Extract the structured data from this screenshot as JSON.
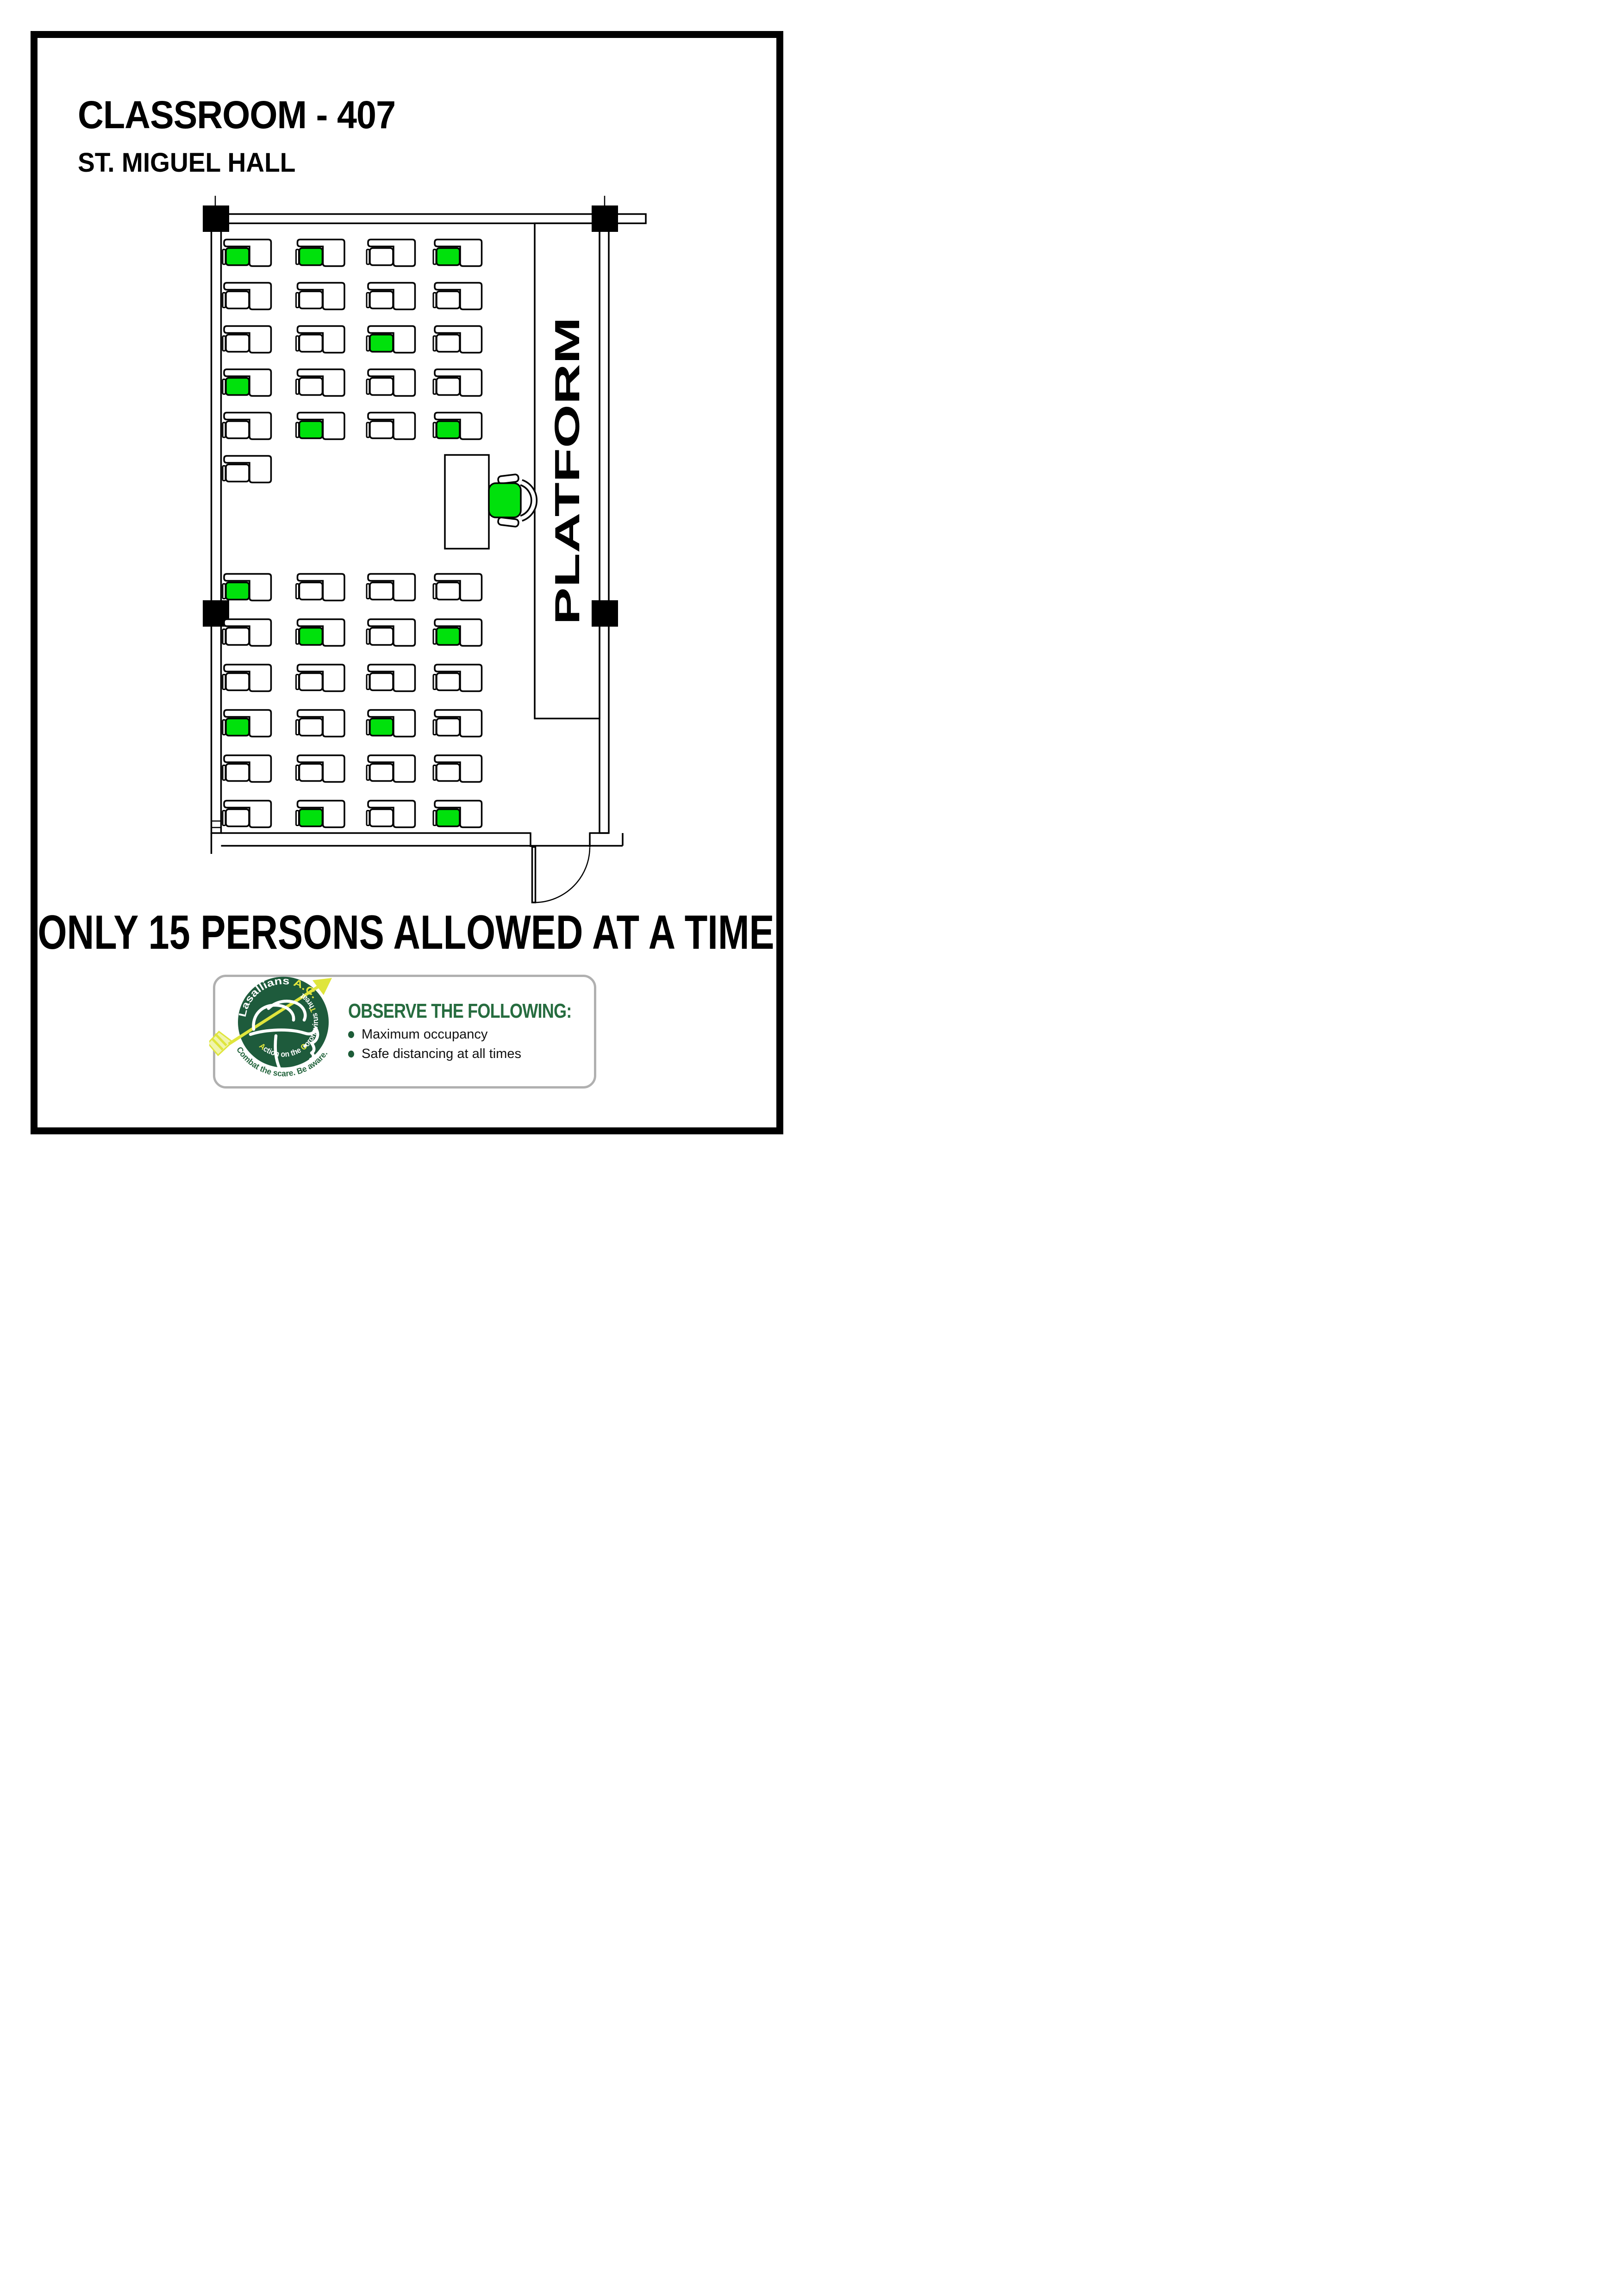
{
  "header": {
    "room_title": "CLASSROOM - 407",
    "building": "ST. MIGUEL HALL"
  },
  "capacity_notice": "ONLY 15 PERSONS ALLOWED AT A TIME",
  "floor_plan": {
    "platform_label": "PLATFORM",
    "persons_allowed": 15,
    "colors": {
      "seat_available": "#00E10C",
      "line": "#000000"
    },
    "seat_legend": {
      "G": "allowed seat (green)",
      "W": "blocked seat (white)",
      "-": "no desk"
    },
    "sections": [
      {
        "name": "platform-side block (top)",
        "rows": [
          "GGWG",
          "WWWW",
          "WWGW",
          "GWWW",
          "WGWG",
          "W---"
        ]
      },
      {
        "name": "door-side block (bottom)",
        "rows": [
          "GWWW",
          "WGWG",
          "WWWW",
          "GWGW",
          "WWWW",
          "WGWG"
        ]
      }
    ],
    "teacher_chair": "G"
  },
  "badge": {
    "headline": "OBSERVE THE FOLLOWING:",
    "bullets": [
      "Maximum occupancy",
      "Safe distancing at all times"
    ],
    "bullet_color": "#1d5c38",
    "headline_color": "#266c3f",
    "logo": {
      "circle_color": "#1e5b3c",
      "accent_yellow": "#e6e93e",
      "arc_primary": [
        {
          "t": "Lasallians ",
          "c": "#ffffff"
        },
        {
          "t": "A.C.T.",
          "c": "#e6e93e"
        }
      ],
      "arc_secondary": [
        {
          "t": "A",
          "c": "#e6e93e"
        },
        {
          "t": "ction on the ",
          "c": "#ffffff"
        },
        {
          "t": "C",
          "c": "#e6e93e"
        },
        {
          "t": "oronavirus ",
          "c": "#ffffff"
        },
        {
          "t": "T",
          "c": "#e6e93e"
        },
        {
          "t": "hreat",
          "c": "#ffffff"
        }
      ],
      "tagline": "Combat the scare. Be aware."
    }
  }
}
